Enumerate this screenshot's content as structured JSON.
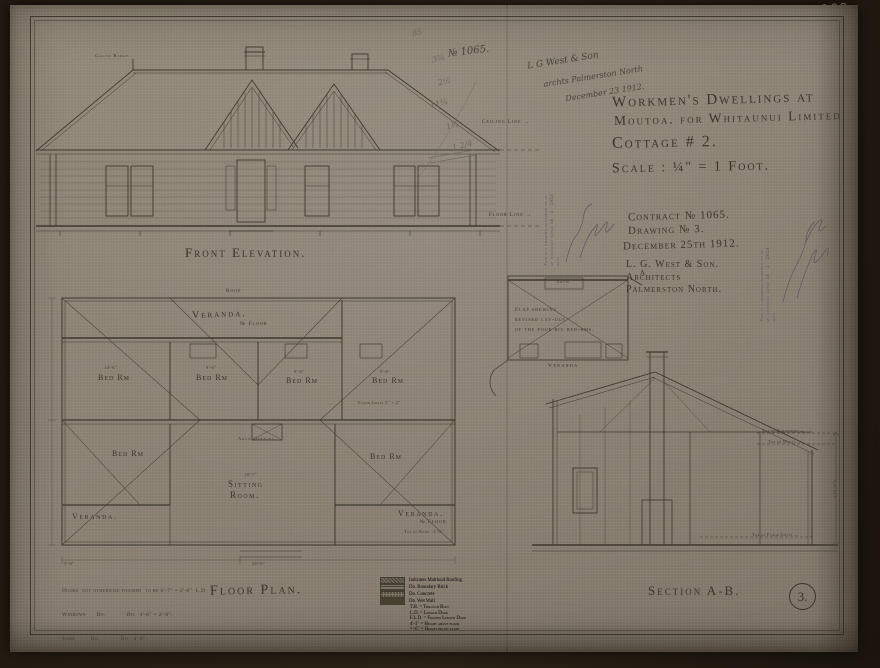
{
  "photo": {
    "corner_number": "109"
  },
  "title_block": {
    "line1": "Workmen's Dwellings at",
    "line2": "Moutoa. for Whitaunui Limited.",
    "line3": "Cottage # 2.",
    "line4": "Scale : ¼\" = 1 Foot."
  },
  "contract_block": {
    "contract": "Contract № 1065.",
    "drawing": "Drawing № 3.",
    "date": "December 25th 1912.",
    "firm": "L. G. West & Son.",
    "role": "Architects",
    "city": "Palmerston North."
  },
  "stamp": {
    "line1": "This is a drawing referred to in",
    "line2": "my contract dated 16 · 1 · 1913",
    "line3": "with"
  },
  "handwritten": {
    "number": "№ 1065.",
    "line1": "L G West & Son",
    "line2": "archts  Palmerston North",
    "line3": "December 23 1912.",
    "pencil": [
      "85",
      "3¾",
      "2½",
      "11¾",
      "1¾",
      "1 2/4"
    ]
  },
  "elevation": {
    "title": "Front Elevation.",
    "ceiling_line": "Ceiling Line →",
    "floor_line": "Floor Line →",
    "ridge": "Galvd Ridge"
  },
  "floor_plan": {
    "title": "Floor Plan.",
    "veranda": "Veranda.",
    "no_floor": "№ Floor",
    "bed_rm": "Bed Rm",
    "sitting1": "Sitting",
    "sitting2": "Room.",
    "arch_opening": "Arch Opening",
    "roof": "Roof",
    "dim_bed1": "14'-6\"",
    "dim_bed2": "9'-6\"",
    "dim_sitting": "18'-7\"",
    "dim_width": "36'-0\"",
    "dim_left": "5'-6\"",
    "joists": "Floor Joists 5\" × 2\"",
    "kerb": "Top of Kerb −1'-6\""
  },
  "small_plan": {
    "note1": "Flap shewing",
    "note2": "revised lay-out",
    "note3": "of the four big bed-rms.",
    "veranda": "Veranda",
    "arch": "Arch",
    "marker_a": "A"
  },
  "section": {
    "title": "Section A-B.",
    "top_partitions": "Top of Partitions →",
    "top_walls": "Top of Walls →",
    "top_joists": "Top of Floor Joists →",
    "dim": "(10'-6\")"
  },
  "legend": {
    "swatch_rows": [
      {
        "label": "Indicates Malthoid Roofing"
      },
      {
        "label": "Do.   Boundary Brick"
      },
      {
        "label": "Do.   Concrete"
      },
      {
        "label": "Do.   Wet Wall"
      }
    ],
    "text_rows": [
      "T.B. = Through Bolt",
      "L.D. = Ledged Door",
      "F.L.D. = Framed Ledged Door",
      "4'-1\" = Height above floor",
      "×'-6\" = Height below plate"
    ]
  },
  "notes": {
    "line1": "Doors  not otherwise figured  to be 6'-7\" × 2'-8\"  L.D.",
    "line2": "Windows      Do.            Do.  4'-6\" × 2'-6\".",
    "line3": "Sash         Do.            Do.  4'-6\"."
  },
  "sheet": {
    "number": "3."
  }
}
